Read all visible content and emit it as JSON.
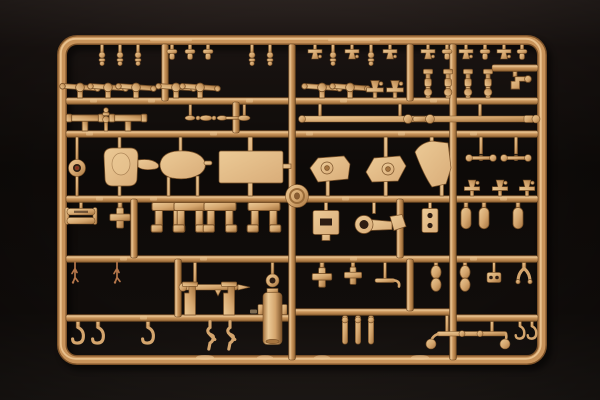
{
  "image": {
    "description": "Close-up product photograph of an unassembled tan styrene model-kit sprue (injection-molded parts tree) lying on a dark surface; dozens of small detail parts attached to a rounded rectangular runner frame with internal cross runners",
    "subject": "model-kit-sprue",
    "plastic_color_name": "sand tan",
    "background_name": "black studio background",
    "legible_text": "none (only faint embossed mold markings)"
  },
  "palette": {
    "bg_top": "#2b2320",
    "bg_upper": "#191311",
    "bg_mid": "#0d0a08",
    "bg_low": "#110d0b",
    "bg_bottom": "#1f1a17",
    "pl_edge": "#7c5229",
    "pl_dark": "#63411f",
    "pl_main": "#c8935a",
    "pl_hi": "#eec997",
    "pl_part": "#d4a56d",
    "pl_part_hi": "#ecca96",
    "pl_part_dk": "#a5743f",
    "pl_plate": "#d9ad79",
    "hole": "#2e1d12",
    "twig": "#b5764a"
  }
}
